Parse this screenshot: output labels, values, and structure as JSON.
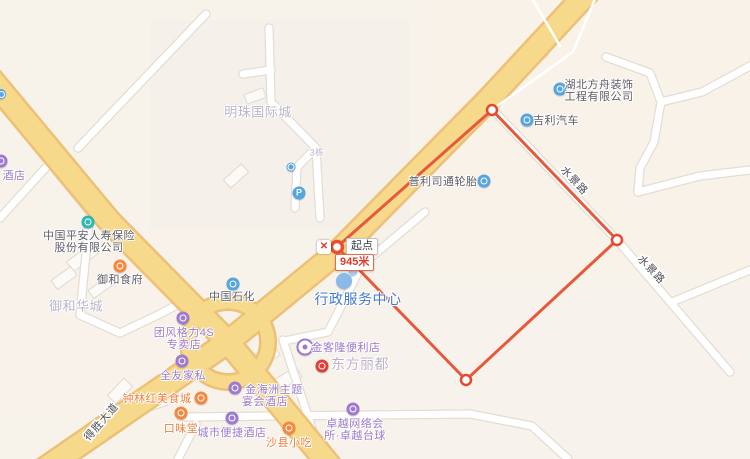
{
  "map": {
    "width": 750,
    "height": 459,
    "colors": {
      "bg": "#F7F3EB",
      "road_fill": "#F7D98B",
      "road_casing": "#EDC077",
      "minor_fill": "#FFFFFF",
      "minor_casing": "#E3DDD3",
      "building_fill": "#FCFAF7",
      "building_stroke": "#E0DAD1",
      "purple": "#9E7BD0",
      "purple_text": "#9B79C8",
      "orange": "#F5883E",
      "orange_text": "#EE7E3E",
      "blue": "#55A6DF",
      "teal": "#2EB8B0",
      "red": "#E23E35",
      "gray_text": "#5E5B66",
      "area_text": "#BCB3CB",
      "gov_text": "#4379C8",
      "gov_icon": "#8BBAE8",
      "gov_icon2": "#A8CBEF",
      "measure": "#E8593B",
      "measure_text": "#E03A2C",
      "road_label_text": "#4E4B55"
    },
    "tints": [
      {
        "x": 430,
        "y": 0,
        "w": 320,
        "h": 270,
        "c": "#F8F2E9"
      },
      {
        "x": 150,
        "y": 20,
        "w": 260,
        "h": 210,
        "c": "#F5F1EA"
      },
      {
        "x": 0,
        "y": 230,
        "w": 215,
        "h": 175,
        "c": "#F8F2EA"
      },
      {
        "x": 340,
        "y": 290,
        "w": 410,
        "h": 169,
        "c": "#F8F2EC"
      }
    ],
    "roads": {
      "major": [
        {
          "pts": [
            [
              590,
              -10
            ],
            [
              488,
              100
            ],
            [
              340,
              250
            ],
            [
              228,
              342
            ],
            [
              40,
              472
            ]
          ]
        },
        {
          "pts": [
            [
              -8,
              80
            ],
            [
              110,
              222
            ],
            [
              228,
              342
            ],
            [
              335,
              472
            ]
          ]
        }
      ],
      "roundabout": {
        "cx": 228,
        "cy": 342,
        "r": 40
      },
      "minor": [
        {
          "pts": [
            [
              206,
              14
            ],
            [
              78,
              148
            ]
          ]
        },
        {
          "pts": [
            [
              269,
              28
            ],
            [
              271,
              102
            ],
            [
              316,
              148
            ],
            [
              320,
              218
            ]
          ]
        },
        {
          "pts": [
            [
              271,
              70
            ],
            [
              243,
              74
            ]
          ]
        },
        {
          "pts": [
            [
              316,
              148
            ],
            [
              297,
              167
            ],
            [
              295,
              208
            ]
          ]
        },
        {
          "pts": [
            [
              493,
              110
            ],
            [
              617,
              240
            ],
            [
              730,
              372
            ]
          ]
        },
        {
          "pts": [
            [
              672,
              302
            ],
            [
              750,
              270
            ]
          ]
        },
        {
          "pts": [
            [
              606,
              57
            ],
            [
              650,
              73
            ],
            [
              661,
              102
            ],
            [
              654,
              142
            ],
            [
              640,
              168
            ],
            [
              638,
              192
            ]
          ]
        },
        {
          "pts": [
            [
              661,
              102
            ],
            [
              702,
              92
            ],
            [
              750,
              66
            ]
          ]
        },
        {
          "pts": [
            [
              638,
              192
            ],
            [
              700,
              176
            ],
            [
              750,
              170
            ]
          ]
        },
        {
          "pts": [
            [
              50,
              163
            ],
            [
              0,
              218
            ]
          ]
        },
        {
          "pts": [
            [
              50,
              163
            ],
            [
              90,
              212
            ],
            [
              80,
              315
            ]
          ]
        },
        {
          "pts": [
            [
              80,
              315
            ],
            [
              120,
              333
            ],
            [
              160,
              314
            ],
            [
              184,
              301
            ]
          ]
        },
        {
          "pts": [
            [
              185,
              417
            ],
            [
              470,
              414
            ],
            [
              532,
              426
            ],
            [
              568,
              459
            ]
          ]
        },
        {
          "pts": [
            [
              283,
              340
            ],
            [
              322,
              459
            ]
          ]
        },
        {
          "pts": [
            [
              425,
              212
            ],
            [
              362,
              265
            ],
            [
              328,
              332
            ],
            [
              284,
              341
            ]
          ]
        },
        {
          "pts": [
            [
              196,
              424
            ],
            [
              178,
              459
            ]
          ]
        }
      ],
      "thin": [
        {
          "pts": [
            [
              597,
              -6
            ],
            [
              573,
              52
            ],
            [
              497,
              106
            ]
          ]
        },
        {
          "pts": [
            [
              533,
              0
            ],
            [
              560,
              46
            ]
          ]
        }
      ],
      "labels": [
        {
          "text": "水景路",
          "x": 572,
          "y": 183,
          "angle": 47
        },
        {
          "text": "水景路",
          "x": 649,
          "y": 272,
          "angle": 47
        },
        {
          "text": "得胜大道",
          "x": 104,
          "y": 424,
          "angle": -49
        }
      ]
    },
    "buildings": [
      {
        "x": 532,
        "y": 60,
        "w": 32,
        "h": 13,
        "r": -40
      },
      {
        "x": 236,
        "y": 176,
        "w": 24,
        "h": 11,
        "r": -42
      },
      {
        "x": 255,
        "y": 96,
        "w": 20,
        "h": 10,
        "r": -20
      },
      {
        "x": 82,
        "y": 258,
        "w": 30,
        "h": 12,
        "r": -36
      },
      {
        "x": 64,
        "y": 278,
        "w": 24,
        "h": 11,
        "r": -36
      },
      {
        "x": 100,
        "y": 288,
        "w": 22,
        "h": 10,
        "r": -36
      },
      {
        "x": 262,
        "y": 358,
        "w": 34,
        "h": 14,
        "r": -32
      },
      {
        "x": 287,
        "y": 379,
        "w": 28,
        "h": 12,
        "r": -32
      },
      {
        "x": 152,
        "y": 404,
        "w": 30,
        "h": 12,
        "r": -18
      },
      {
        "x": 120,
        "y": 391,
        "w": 24,
        "h": 12,
        "r": -46
      }
    ],
    "pois": [
      {
        "id": "hotel-left-edge",
        "icon": {
          "name": "hotel-icon",
          "x": 1,
          "y": 161,
          "color": "purple",
          "size": 13,
          "glyph": "ring"
        },
        "lines": [
          {
            "text": "酒店",
            "x": 14,
            "y": 175,
            "color": "purple_text"
          }
        ]
      },
      {
        "id": "bus-stop-top-left",
        "icon": {
          "name": "bus-stop-icon",
          "x": 1,
          "y": 94,
          "color": "blue",
          "size": 10,
          "glyph": "ring"
        },
        "lines": []
      },
      {
        "id": "mingzhu-area",
        "lines": [
          {
            "text": "明珠国际城",
            "x": 258,
            "y": 111,
            "color": "area_text",
            "size": 13
          }
        ]
      },
      {
        "id": "building-3",
        "lines": [
          {
            "text": "3栋",
            "x": 317,
            "y": 152,
            "color": "area_text",
            "size": 9
          }
        ]
      },
      {
        "id": "poi-small-blue",
        "icon": {
          "name": "poi-icon",
          "x": 291,
          "y": 167,
          "color": "blue",
          "size": 9,
          "glyph": "ring"
        },
        "lines": []
      },
      {
        "id": "parking",
        "icon": {
          "name": "parking-icon",
          "x": 299,
          "y": 193,
          "color": "blue",
          "size": 13,
          "glyph": "P"
        },
        "lines": []
      },
      {
        "id": "hubei-fangzhou",
        "icon": {
          "name": "company-icon",
          "x": 560,
          "y": 89,
          "color": "blue",
          "size": 13,
          "glyph": "ring"
        },
        "lines": [
          {
            "text": "湖北方舟装饰",
            "x": 599,
            "y": 84,
            "color": "gray_text"
          },
          {
            "text": "工程有限公司",
            "x": 599,
            "y": 96,
            "color": "gray_text"
          }
        ]
      },
      {
        "id": "jili-auto",
        "icon": {
          "name": "car-dealer-icon",
          "x": 527,
          "y": 120,
          "color": "blue",
          "size": 13,
          "glyph": "ring"
        },
        "lines": [
          {
            "text": "吉利汽车",
            "x": 556,
            "y": 120,
            "color": "gray_text"
          }
        ]
      },
      {
        "id": "bridgestone",
        "icon": {
          "name": "tire-shop-icon",
          "x": 484,
          "y": 181,
          "color": "blue",
          "size": 13,
          "glyph": "ring"
        },
        "lines": [
          {
            "text": "普利司通轮胎",
            "x": 443,
            "y": 181,
            "color": "gray_text"
          }
        ]
      },
      {
        "id": "pingan-insurance",
        "icon": {
          "name": "insurance-icon",
          "x": 88,
          "y": 222,
          "color": "teal",
          "size": 13,
          "glyph": "ring"
        },
        "lines": [
          {
            "text": "中国平安人寿保险",
            "x": 89,
            "y": 235,
            "color": "gray_text"
          },
          {
            "text": "股份有限公司",
            "x": 89,
            "y": 247,
            "color": "gray_text"
          }
        ]
      },
      {
        "id": "yuhe-restaurant",
        "icon": {
          "name": "restaurant-icon",
          "x": 120,
          "y": 266,
          "color": "orange",
          "size": 13,
          "glyph": "ring"
        },
        "lines": [
          {
            "text": "御和食府",
            "x": 120,
            "y": 279,
            "color": "gray_text"
          }
        ]
      },
      {
        "id": "yuhe-area",
        "lines": [
          {
            "text": "御和华城",
            "x": 76,
            "y": 305,
            "color": "area_text",
            "size": 13
          }
        ]
      },
      {
        "id": "sinopec",
        "icon": {
          "name": "gas-station-icon",
          "x": 233,
          "y": 284,
          "color": "blue",
          "size": 13,
          "glyph": "ring"
        },
        "lines": [
          {
            "text": "中国石化",
            "x": 232,
            "y": 296,
            "color": "gray_text"
          }
        ]
      },
      {
        "id": "government-center",
        "icon": {
          "name": "government-icon",
          "x": 344,
          "y": 281,
          "color": "gov_icon",
          "size": 16,
          "glyph": "none",
          "icon2": {
            "x": 353,
            "y": 271,
            "color": "gov_icon2",
            "size": 9
          }
        },
        "lines": [
          {
            "text": "行政服务中心",
            "x": 358,
            "y": 299,
            "color": "gov_text",
            "size": 14
          }
        ]
      },
      {
        "id": "gree-store",
        "icon": {
          "name": "appliance-store-icon",
          "x": 183,
          "y": 318,
          "color": "purple",
          "size": 13,
          "glyph": "ring"
        },
        "lines": [
          {
            "text": "团风格力4S",
            "x": 184,
            "y": 332,
            "color": "purple_text"
          },
          {
            "text": "专卖店",
            "x": 184,
            "y": 344,
            "color": "purple_text"
          }
        ]
      },
      {
        "id": "quanyou-furniture",
        "icon": {
          "name": "furniture-store-icon",
          "x": 182,
          "y": 361,
          "color": "purple",
          "size": 13,
          "glyph": "ring"
        },
        "lines": [
          {
            "text": "全友家私",
            "x": 183,
            "y": 375,
            "color": "purple_text"
          }
        ]
      },
      {
        "id": "zhonglinhong-food",
        "icon": {
          "name": "food-court-icon",
          "x": 201,
          "y": 398,
          "color": "orange",
          "size": 13,
          "glyph": "ring"
        },
        "lines": [
          {
            "text": "钟林红美食城",
            "x": 157,
            "y": 398,
            "color": "orange_text"
          }
        ]
      },
      {
        "id": "kouweitang",
        "icon": {
          "name": "restaurant-icon",
          "x": 181,
          "y": 413,
          "color": "orange",
          "size": 13,
          "glyph": "ring"
        },
        "lines": [
          {
            "text": "口味堂",
            "x": 181,
            "y": 428,
            "color": "orange_text"
          }
        ]
      },
      {
        "id": "jinhaizhou-hotel",
        "icon": {
          "name": "hotel-icon",
          "x": 235,
          "y": 388,
          "color": "purple",
          "size": 13,
          "glyph": "ring"
        },
        "lines": [
          {
            "text": "金海洲主题",
            "x": 274,
            "y": 389,
            "color": "purple_text"
          },
          {
            "text": "宴会酒店",
            "x": 265,
            "y": 401,
            "color": "purple_text"
          }
        ]
      },
      {
        "id": "city-comfort-inn",
        "icon": {
          "name": "hotel-icon",
          "x": 232,
          "y": 418,
          "color": "purple",
          "size": 13,
          "glyph": "ring"
        },
        "lines": [
          {
            "text": "城市便捷酒店",
            "x": 232,
            "y": 432,
            "color": "purple_text"
          }
        ]
      },
      {
        "id": "shaxian-snacks",
        "icon": {
          "name": "snack-icon",
          "x": 289,
          "y": 428,
          "color": "orange",
          "size": 13,
          "glyph": "ring"
        },
        "lines": [
          {
            "text": "沙县小吃",
            "x": 289,
            "y": 442,
            "color": "orange_text"
          }
        ]
      },
      {
        "id": "jinkelong-store",
        "icon": {
          "name": "convenience-store-icon",
          "x": 305,
          "y": 347,
          "color": "purple",
          "size": 13,
          "glyph": "outline"
        },
        "lines": [
          {
            "text": "金客隆便利店",
            "x": 346,
            "y": 347,
            "color": "purple_text"
          }
        ]
      },
      {
        "id": "dongfang-lidu",
        "icon": {
          "name": "landmark-icon",
          "x": 322,
          "y": 366,
          "color": "red",
          "size": 13,
          "glyph": "ring"
        },
        "lines": [
          {
            "text": "东方丽都",
            "x": 360,
            "y": 364,
            "color": "area_text",
            "size": 14
          }
        ]
      },
      {
        "id": "zhuoyue-club",
        "icon": {
          "name": "internet-cafe-icon",
          "x": 353,
          "y": 409,
          "color": "purple",
          "size": 13,
          "glyph": "ring"
        },
        "lines": [
          {
            "text": "卓越网络会",
            "x": 355,
            "y": 423,
            "color": "purple_text"
          },
          {
            "text": "所·卓越台球",
            "x": 355,
            "y": 435,
            "color": "purple_text"
          }
        ]
      }
    ],
    "measurement": {
      "points": [
        [
          337,
          247
        ],
        [
          492,
          110
        ],
        [
          617,
          240
        ],
        [
          466,
          380
        ]
      ],
      "closed": true,
      "start_point": {
        "x": 337,
        "y": 247
      },
      "vertices": [
        [
          492,
          110
        ],
        [
          617,
          240
        ],
        [
          466,
          380
        ]
      ],
      "start_label": "起点",
      "distance_label": "945米",
      "delete_icon": "✕",
      "boxes": {
        "start": {
          "x": 346,
          "y": 238
        },
        "distance": {
          "x": 335,
          "y": 254
        },
        "delete": {
          "x": 317,
          "y": 240
        }
      }
    }
  }
}
